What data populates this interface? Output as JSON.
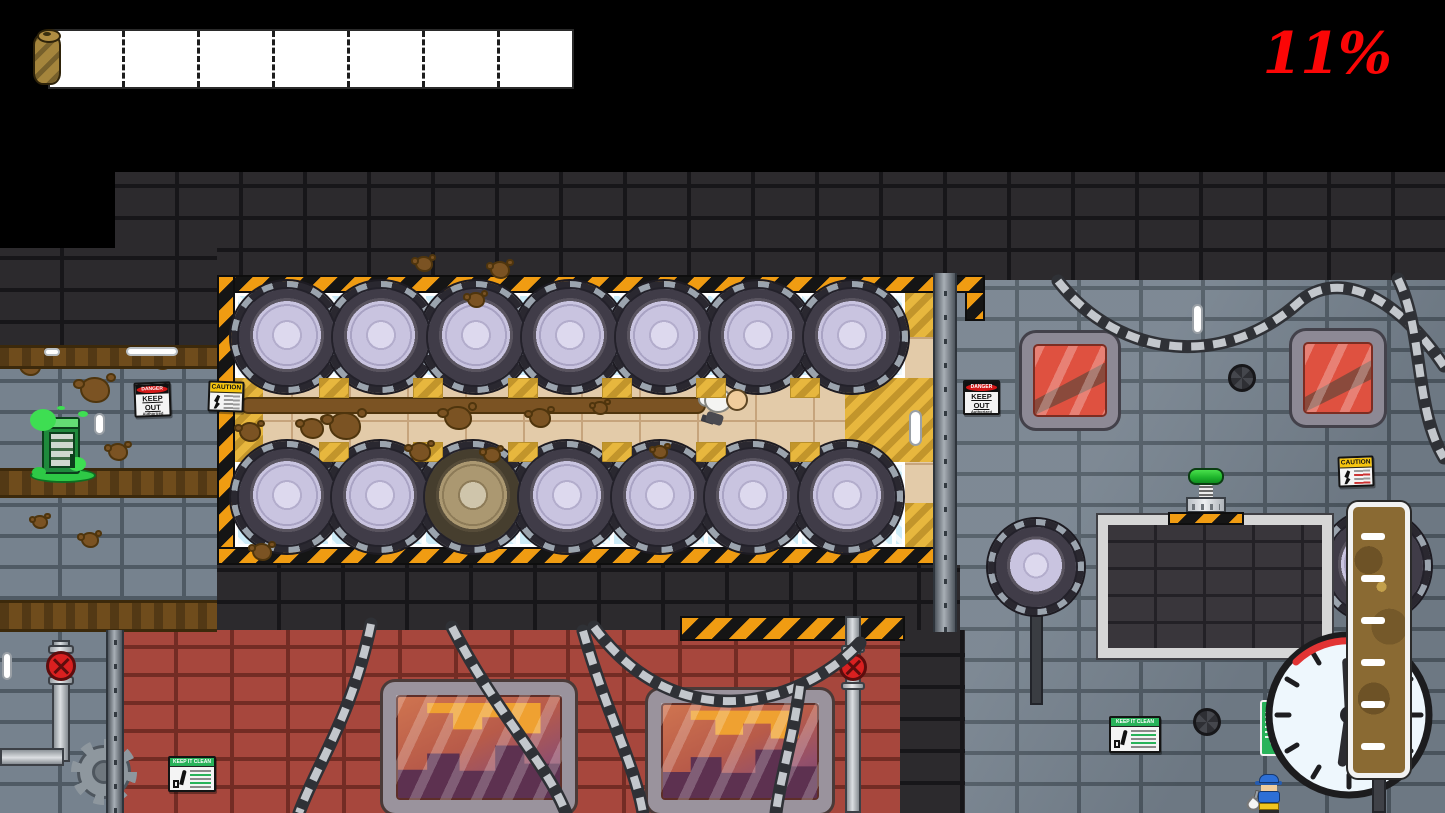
{
  "hud": {
    "completion": "11%",
    "completion_color": "#fb0606",
    "progress_segments": 7
  },
  "signs": {
    "danger": {
      "header": "DANGER",
      "title": "KEEP OUT",
      "subtitle": "Authorized personnel only"
    },
    "caution": {
      "header": "CAUTION"
    },
    "keep_clean": {
      "header": "KEEP IT CLEAN"
    },
    "heart_sign": {
      "heart": "♥"
    }
  },
  "palette": {
    "hazard_orange": "#f09c12",
    "mud_brown": "#7b5323",
    "slime_green": "#3ede52",
    "glass_blue": "#cdecf8",
    "drum_lavender": "#c9c4e0",
    "wall_gray": "#76828e",
    "wall_red": "#a7473d",
    "dark_brick": "#2c2a2d",
    "floor_tan": "#e3cba9",
    "alert_red": "#d41717",
    "sign_green": "#28b35a",
    "button_green": "#2bd13a"
  },
  "scene": {
    "drums": [
      {
        "x": 287,
        "y": 337
      },
      {
        "x": 381,
        "y": 337
      },
      {
        "x": 476,
        "y": 337
      },
      {
        "x": 570,
        "y": 337
      },
      {
        "x": 664,
        "y": 337
      },
      {
        "x": 758,
        "y": 337
      },
      {
        "x": 852,
        "y": 337
      },
      {
        "x": 287,
        "y": 497
      },
      {
        "x": 380,
        "y": 497
      },
      {
        "x": 473,
        "y": 497,
        "v": "dirty"
      },
      {
        "x": 567,
        "y": 497
      },
      {
        "x": 660,
        "y": 497
      },
      {
        "x": 753,
        "y": 497
      },
      {
        "x": 847,
        "y": 497
      },
      {
        "x": 1036,
        "y": 567,
        "v": "sm",
        "s": 80
      },
      {
        "x": 1375,
        "y": 566
      }
    ],
    "splats": [
      {
        "x": 30,
        "y": 366,
        "r": 9
      },
      {
        "x": 95,
        "y": 390,
        "r": 13
      },
      {
        "x": 162,
        "y": 360,
        "r": 9
      },
      {
        "x": 118,
        "y": 452,
        "r": 8
      },
      {
        "x": 250,
        "y": 432,
        "r": 9
      },
      {
        "x": 312,
        "y": 428,
        "r": 10
      },
      {
        "x": 345,
        "y": 426,
        "r": 14
      },
      {
        "x": 420,
        "y": 452,
        "r": 9
      },
      {
        "x": 458,
        "y": 418,
        "r": 12
      },
      {
        "x": 540,
        "y": 418,
        "r": 9
      },
      {
        "x": 600,
        "y": 408,
        "r": 6
      },
      {
        "x": 424,
        "y": 264,
        "r": 7
      },
      {
        "x": 500,
        "y": 270,
        "r": 8
      },
      {
        "x": 262,
        "y": 552,
        "r": 8
      },
      {
        "x": 90,
        "y": 540,
        "r": 7
      },
      {
        "x": 40,
        "y": 522,
        "r": 6
      },
      {
        "x": 660,
        "y": 452,
        "r": 6
      },
      {
        "x": 476,
        "y": 300,
        "r": 7
      },
      {
        "x": 492,
        "y": 455,
        "r": 7
      }
    ],
    "hazard_patches": [
      319,
      413,
      508,
      602,
      696,
      790
    ],
    "chains": [
      "M1058,281 C1120,360 1225,368 1298,303 C1340,266 1400,300 1444,366",
      "M1398,279 C1424,332 1414,408 1444,458",
      "M594,627 C676,738 798,708 860,643",
      "M371,624 C352,716 318,762 299,813",
      "M452,627 C498,716 546,762 566,813",
      "M583,631 C608,718 634,762 643,813",
      "M800,686 C793,740 780,778 776,813"
    ],
    "gauge_ticks": 6
  }
}
